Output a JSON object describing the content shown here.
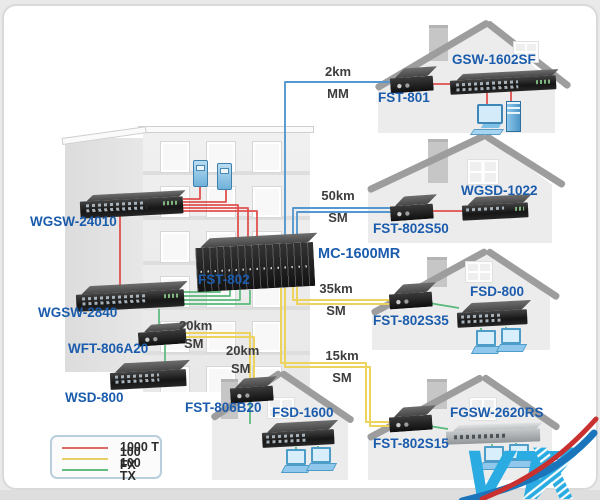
{
  "building": {
    "devices": {
      "switch_top": "WGSW-24010",
      "switch_mid": "WGSW-2840",
      "converter": "WFT-806A20",
      "switch_bottom": "WSD-800",
      "chassis": "MC-1600MR",
      "chassis_modules": "FST-802"
    }
  },
  "links": {
    "l2km": {
      "distance": "2km",
      "mode": "MM"
    },
    "l50km": {
      "distance": "50km",
      "mode": "SM"
    },
    "l35km": {
      "distance": "35km",
      "mode": "SM"
    },
    "l15km": {
      "distance": "15km",
      "mode": "SM"
    },
    "l20km_a": {
      "distance": "20km",
      "mode": "SM"
    },
    "l20km_b": {
      "distance": "20km",
      "mode": "SM"
    }
  },
  "houses": [
    {
      "switch": "GSW-1602SF",
      "converter": "FST-801"
    },
    {
      "switch": "WGSD-1022",
      "converter": "FST-802S50"
    },
    {
      "switch": "FSD-800",
      "converter": "FST-802S35"
    },
    {
      "switch": "FGSW-2620RS",
      "converter": "FST-802S15"
    },
    {
      "switch": "FSD-1600",
      "converter": "FST-806B20"
    }
  ],
  "legend": {
    "items": [
      {
        "label": "1000 T",
        "color": "#d96a64"
      },
      {
        "label": "100 FX",
        "color": "#e6cf66"
      },
      {
        "label": "100 TX",
        "color": "#63bd7c"
      }
    ]
  },
  "watermark": {
    "text_vt": "VT",
    "text_x": "X",
    "blue": "#2aace3",
    "swoosh_red": "#c8312f",
    "swoosh_blue": "#1b75bb"
  },
  "colors": {
    "line_1000t": "#e0504e",
    "line_100fx": "#ecd35e",
    "line_100tx": "#58b97a",
    "fiber_blue": "#5598cf",
    "label_blue": "#1b5cad",
    "distance_text": "#3d3d3d"
  }
}
